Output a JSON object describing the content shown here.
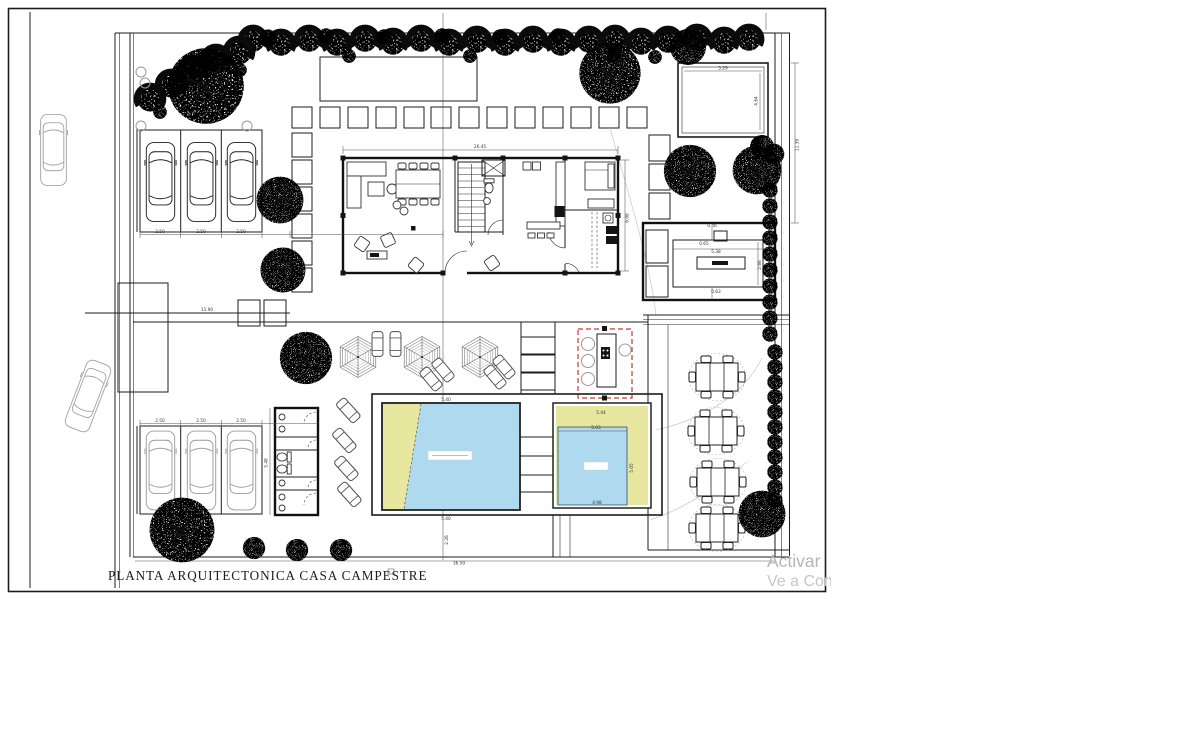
{
  "drawing": {
    "title": "PLANTA ARQUITECTONICA CASA CAMPESTRE"
  },
  "watermark": {
    "line1": "Activar",
    "line2": "Ve a Conf"
  },
  "colors": {
    "pool_water": "#aed9ee",
    "deck_yellow": "#e8e7a0",
    "bar_outline_red": "#c23b2e",
    "watermark_gray": "#b5b5b5",
    "line_black": "#1c1c1c"
  },
  "dims": {
    "pavilion_width": "5.29",
    "pavilion_height": "4.64",
    "right_height": "11.39",
    "house_width": "26.45",
    "house_depth": "6.08",
    "bbq_top_offset": "0.46",
    "bbq_counter_depth": "0.65",
    "bbq_width": "5.38",
    "bbq_depth": "2.66",
    "bbq_bottom_offset": "0.63",
    "bbq_side": "0.53",
    "garage_top_stalls": [
      "2.50",
      "2.50",
      "2.50"
    ],
    "garage_bottom_stalls": [
      "2.50",
      "2.50",
      "2.50"
    ],
    "pool_left_width_top": "5.40",
    "pool_left_width_bottom": "5.40",
    "pool_right_width": "5.44",
    "pool_right_inner_width": "5.03",
    "pool_right_inner_height": "5.05",
    "pool_right_bottom": "4.98",
    "court_gap": "2.26",
    "site_width_total": "36.50",
    "driveway_span": "11.90",
    "bath_block_height": "5.48"
  }
}
